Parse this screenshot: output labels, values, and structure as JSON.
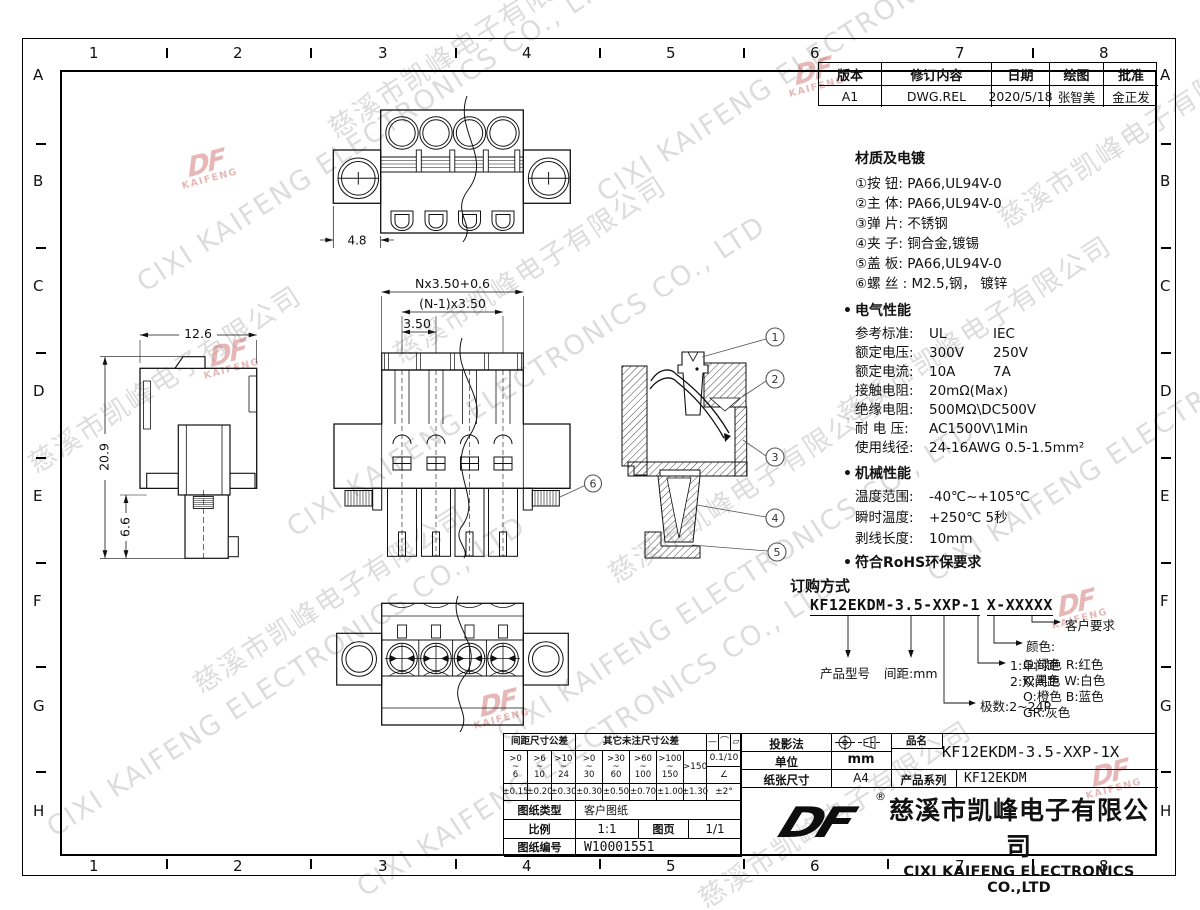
{
  "frame": {
    "cols": [
      "1",
      "2",
      "3",
      "4",
      "5",
      "6",
      "7",
      "8"
    ],
    "rows": [
      "A",
      "B",
      "C",
      "D",
      "E",
      "F",
      "G",
      "H"
    ]
  },
  "revision": {
    "headers": [
      "版本",
      "修订内容",
      "日期",
      "绘图",
      "批准"
    ],
    "row": [
      "A1",
      "DWG.REL",
      "2020/5/18",
      "张智美",
      "金正发"
    ]
  },
  "material": {
    "title": "材质及电镀",
    "items": [
      "①按 钮: PA66,UL94V-0",
      "②主 体: PA66,UL94V-0",
      "③弹 片: 不锈钢",
      "④夹 子: 铜合金,镀锡",
      "⑤盖 板: PA66,UL94V-0",
      "⑥螺 丝 : M2.5,钢， 镀锌"
    ]
  },
  "electrical": {
    "bullet": "•",
    "title": "电气性能",
    "rows": [
      {
        "label": "参考标准:",
        "v1": "UL",
        "v2": "IEC"
      },
      {
        "label": "额定电压:",
        "v1": "300V",
        "v2": "250V"
      },
      {
        "label": "额定电流:",
        "v1": "10A",
        "v2": "7A"
      },
      {
        "label": "接触电阻:",
        "v1": "20mΩ(Max)",
        "v2": ""
      },
      {
        "label": "绝缘电阻:",
        "v1": "500MΩ\\DC500V",
        "v2": ""
      },
      {
        "label": "耐 电 压:",
        "v1": "AC1500V\\1Min",
        "v2": ""
      },
      {
        "label": "使用线径:",
        "v1": "24-16AWG 0.5-1.5mm²",
        "v2": ""
      }
    ]
  },
  "mechanical": {
    "bullet": "•",
    "title": "机械性能",
    "rows": [
      {
        "label": "温度范围:",
        "v1": "-40℃~+105℃"
      },
      {
        "label": "瞬时温度:",
        "v1": "+250℃ 5秒"
      },
      {
        "label": "剥线长度:",
        "v1": "10mm"
      }
    ]
  },
  "rohs": {
    "bullet": "•",
    "text": "符合RoHS环保要求"
  },
  "ordering": {
    "title": "订购方式",
    "pn1": "KF12EKDM-3.5-XXP-1",
    "pn2": "X-XXXXX",
    "product": "产品型号",
    "pitch": "间距:mm",
    "poles": "极数:2~24P",
    "opt1": "1:单间距",
    "opt2": "2:双间距",
    "customer": "客户要求",
    "color_title": "颜色:",
    "colors": [
      "G:绿色  R:红色",
      "K:黑色  W:白色",
      "O:橙色  B:蓝色",
      "GR:灰色"
    ]
  },
  "dims": {
    "pitch_total": "Nx3.50+0.6",
    "pitch_n1": "(N-1)x3.50",
    "pitch": "3.50",
    "top_width": "4.8",
    "side_width": "12.6",
    "side_height": "20.9",
    "side_lower": "6.6"
  },
  "callouts": {
    "c1": "1",
    "c2": "2",
    "c3": "3",
    "c4": "4",
    "c5": "5",
    "c6": "6"
  },
  "tolerance": {
    "hdr_left": "间距尺寸公差",
    "hdr_right": "其它未注尺寸公差",
    "tilde": "~",
    "sym1": "—",
    "sym2": "⌒",
    "sym3": "▱",
    "flat": "0.1/10",
    "angle_sym": "∠",
    "angle_tol": "±2°",
    "left_ranges": [
      {
        "t": ">0",
        "b": "6"
      },
      {
        "t": ">6",
        "b": "10"
      },
      {
        "t": ">10",
        "b": "24"
      }
    ],
    "right_ranges": [
      {
        "t": ">0",
        "b": "30"
      },
      {
        "t": ">30",
        "b": "60"
      },
      {
        "t": ">60",
        "b": "100"
      },
      {
        "t": ">100",
        "b": "150"
      }
    ],
    "range_150": ">150",
    "left_tols": [
      "±0.15",
      "±0.20",
      "±0.30"
    ],
    "right_tols": [
      "±0.30",
      "±0.50",
      "±0.70",
      "±1.00",
      "±1.30"
    ],
    "doc_type_label": "图纸类型",
    "doc_type": "客户图纸",
    "scale_label": "比例",
    "scale": "1:1",
    "page_label": "图页",
    "page": "1/1",
    "doc_no_label": "图纸编号",
    "doc_no": "W10001551"
  },
  "titleblock": {
    "projection_label": "投影法",
    "unit_label": "单位",
    "unit": "mm",
    "paper_label": "纸张尺寸",
    "paper": "A4",
    "part_label": "品名",
    "part_name": "KF12EKDM-3.5-XXP-1X",
    "series_label": "产品系列",
    "series": "KF12EKDM",
    "reg": "®",
    "logo": "DF",
    "company_cn": "慈溪市凯峰电子有限公司",
    "company_en": "CIXI KAIFENG ELECTRONICS CO.,LTD"
  },
  "watermark": {
    "cn": "慈溪市凯峰电子有限公司",
    "en": "CIXI KAIFENG ELECTRONICS CO., LTD",
    "logo": "DF",
    "logo_sub": "KAIFENG"
  }
}
